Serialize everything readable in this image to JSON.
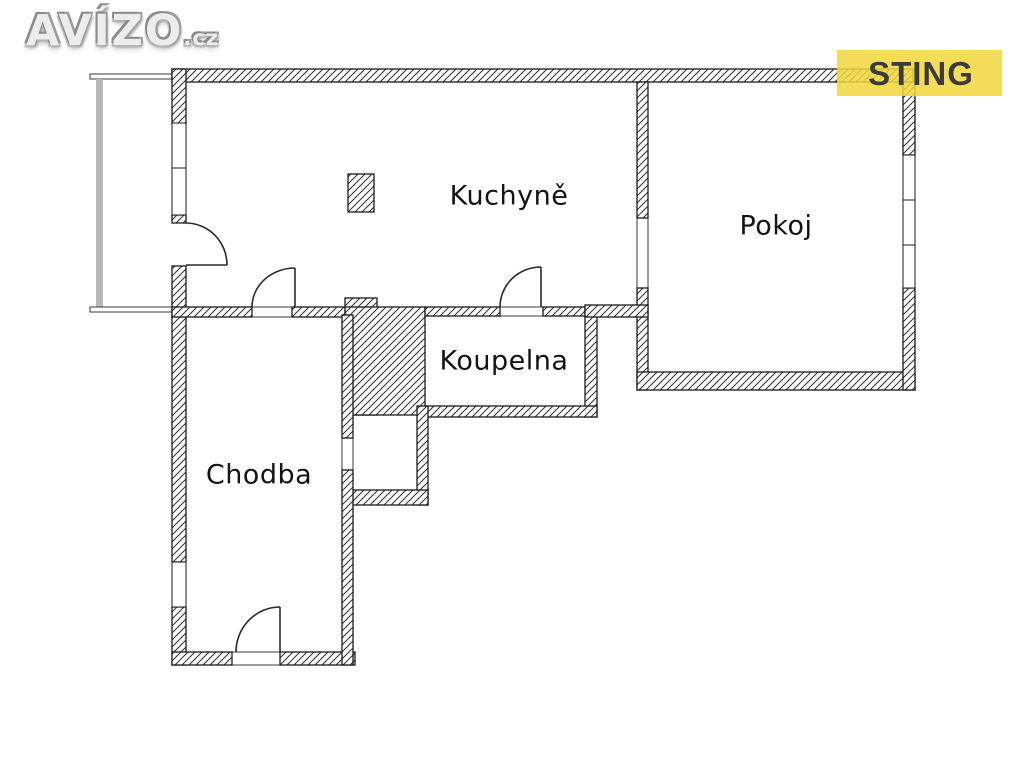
{
  "branding": {
    "portal_logo": {
      "text": "AVÍZO",
      "suffix": ".cz"
    },
    "agency_badge": {
      "label": "STING",
      "bg_color": "#f0d63c",
      "text_color": "#3b3b3b"
    }
  },
  "floorplan": {
    "type": "apartment-floor-plan",
    "rooms": [
      {
        "id": "kuchyne",
        "label": "Kuchyně"
      },
      {
        "id": "pokoj",
        "label": "Pokoj"
      },
      {
        "id": "koupelna",
        "label": "Koupelna"
      },
      {
        "id": "chodba",
        "label": "Chodba"
      }
    ],
    "features": [
      "balcony-glazing",
      "entrance-door",
      "balcony-door",
      "kitchen-hall-door",
      "kitchen-bath-door",
      "room-opening",
      "hall-niche",
      "chimney-pillar",
      "windows"
    ],
    "colors": {
      "background": "#ffffff",
      "wall_outline": "#1b1b1b",
      "hatch_line": "#2e2e2e",
      "door_line": "#2a2a2a",
      "balcony_glazing": "#b8b8b8"
    }
  }
}
